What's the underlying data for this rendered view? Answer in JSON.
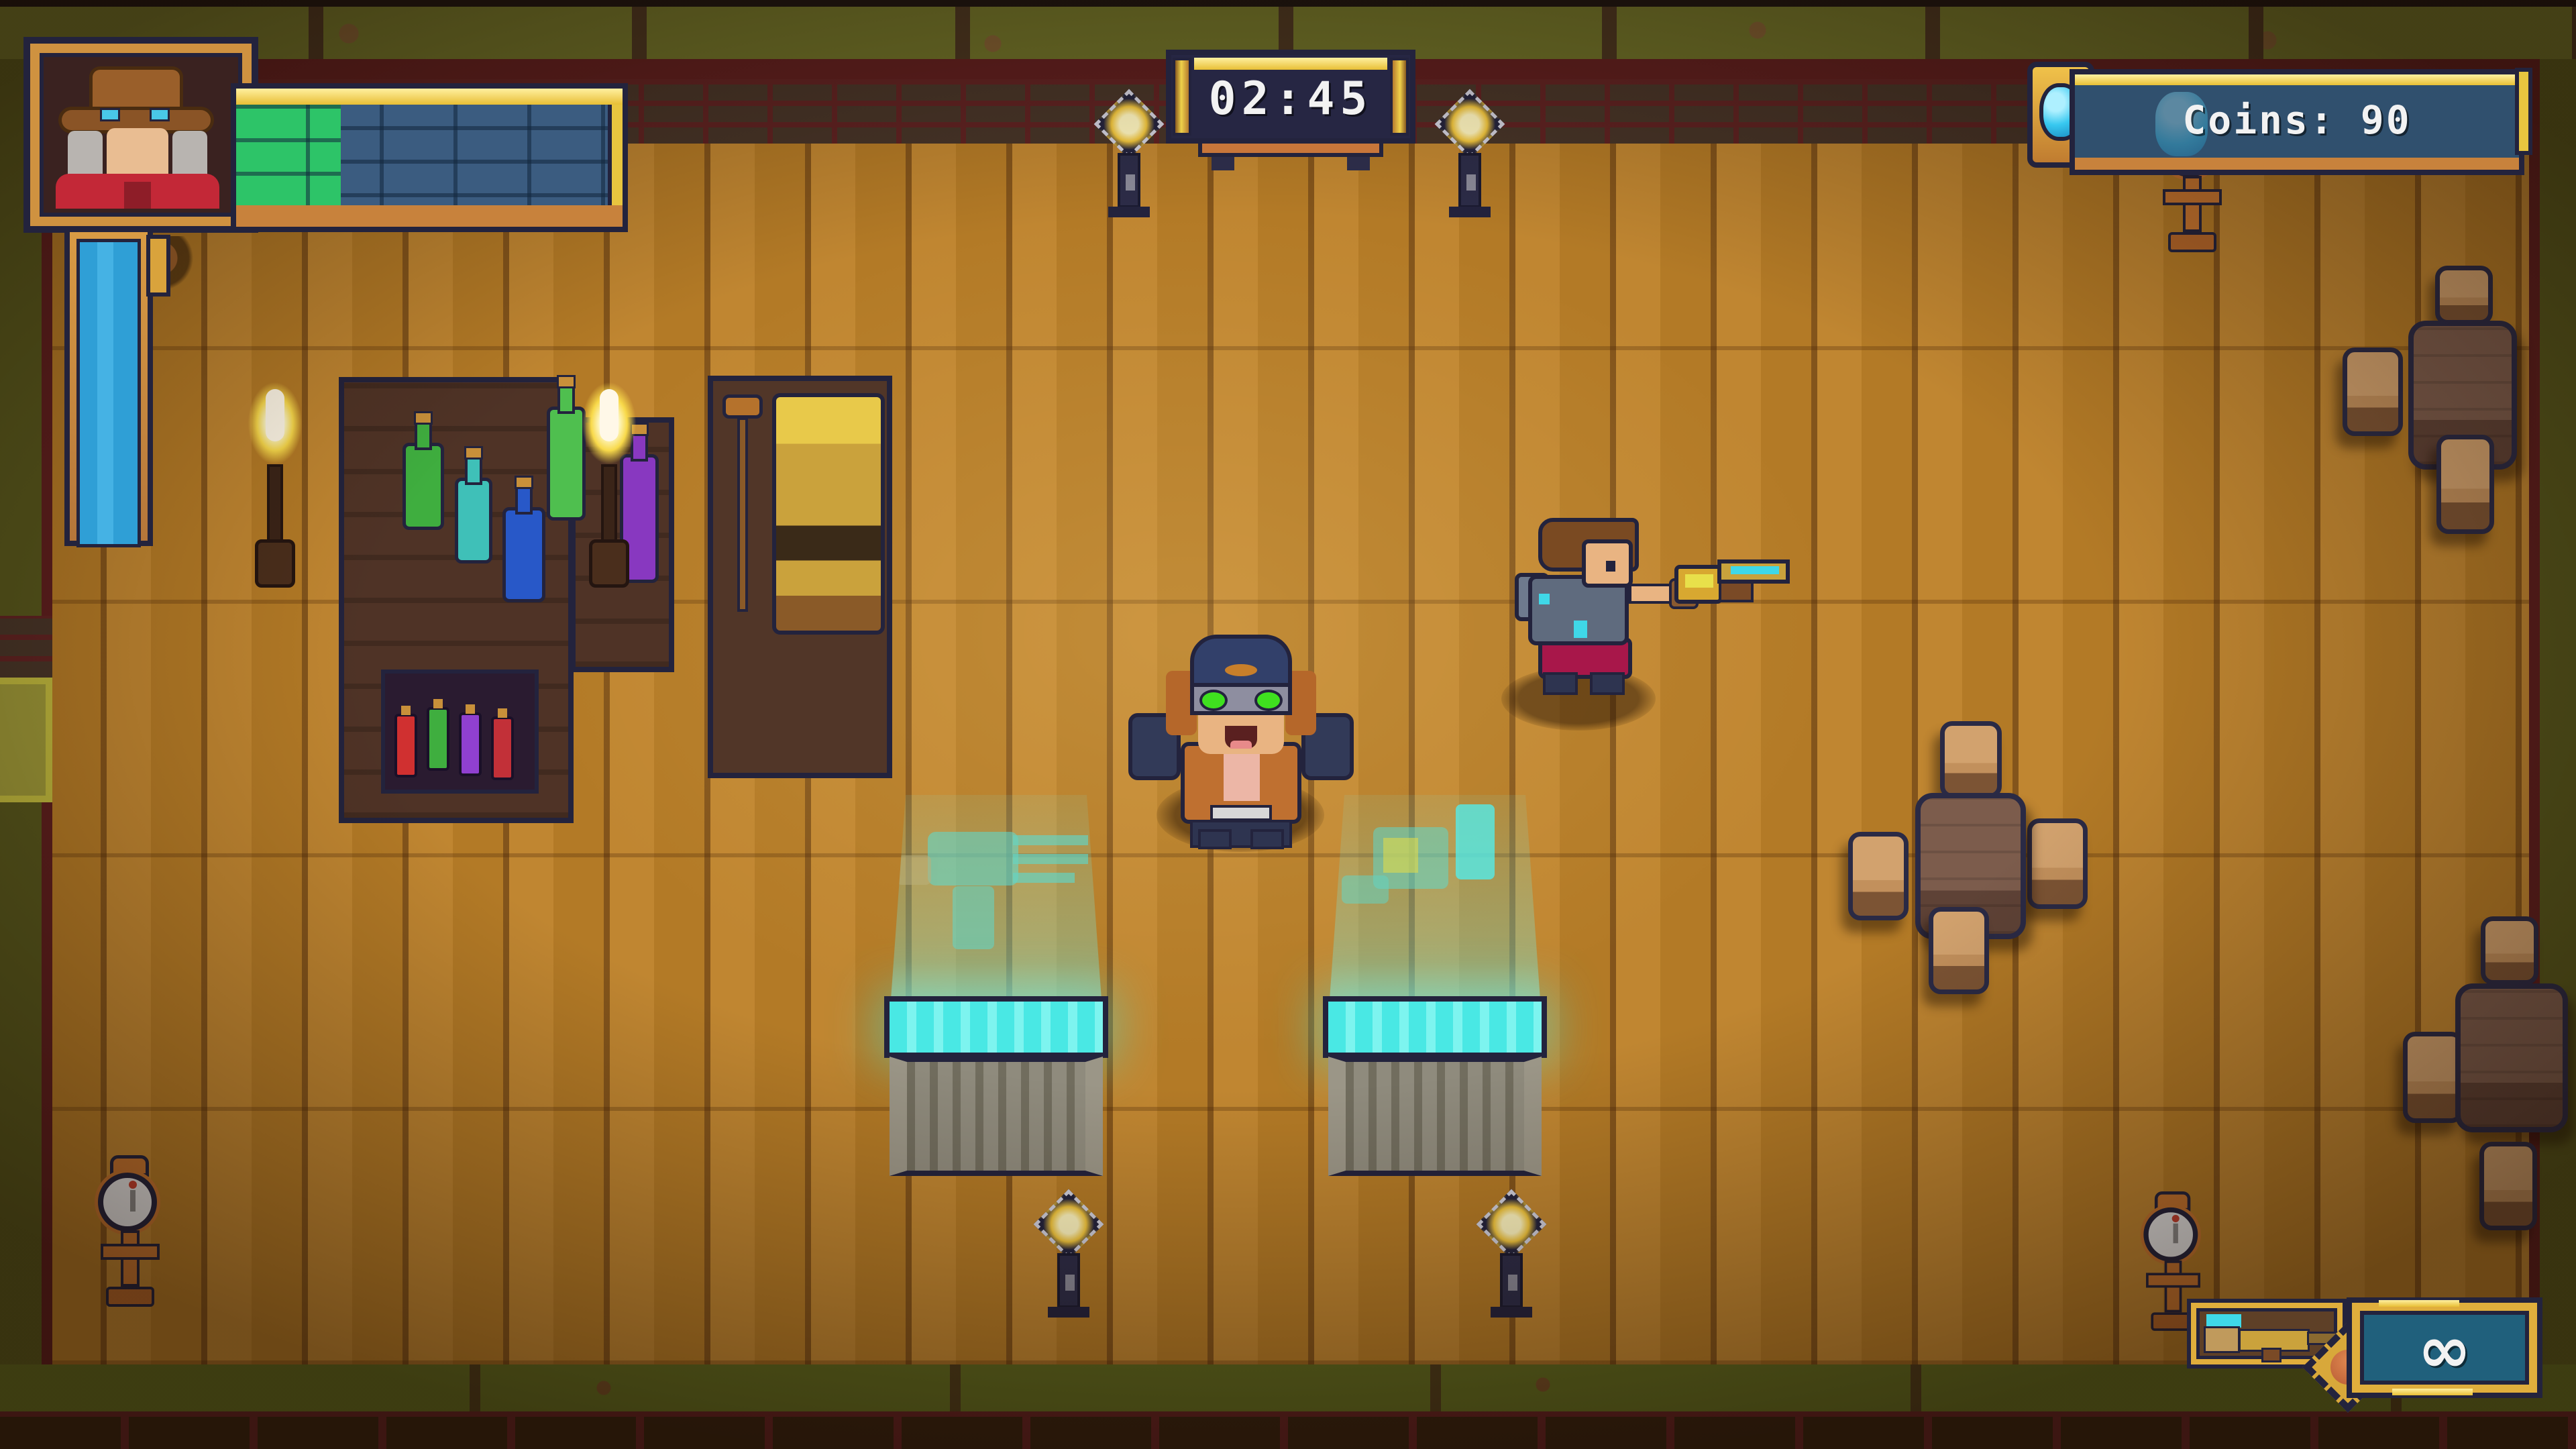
{
  "hud": {
    "timer": {
      "value": "02:45"
    },
    "coins": {
      "label": "Coins: 90",
      "gem_icon": "blue-gem-icon",
      "gem_color": "#38c8f0"
    },
    "health_bar": {
      "percent": "27%",
      "fill_color": "#2dc468",
      "empty_color": "#3b5c80"
    },
    "special_meter": {
      "percent": "100%",
      "fill_color": "#2f9fd6"
    },
    "ammo": {
      "count": "∞",
      "weapon_icon": "golden-rifle-icon",
      "charge_icon": "ember-orb-icon"
    },
    "portrait": {
      "icon": "gunslinger-portrait-icon"
    }
  },
  "world": {
    "npc": "shopkeeper-with-goggles",
    "player": "gunslinger-with-golden-rifle",
    "display_cases": [
      "minigun-hologram",
      "blaster-hologram"
    ],
    "shop_items": [
      "potion-bottles",
      "cash-register"
    ]
  },
  "colors": {
    "hud_frame_gold": "#e8bf35",
    "hud_frame_copper": "#c8823c",
    "hud_outline_navy": "#23233d",
    "panel_blue": "#30506e",
    "ammo_teal": "#20607c",
    "hologram_cyan": "#49e8e4",
    "floor_wood": "#b97e2a",
    "wall_olive": "#6a6d27",
    "wall_maroon": "#5c1e1e"
  }
}
